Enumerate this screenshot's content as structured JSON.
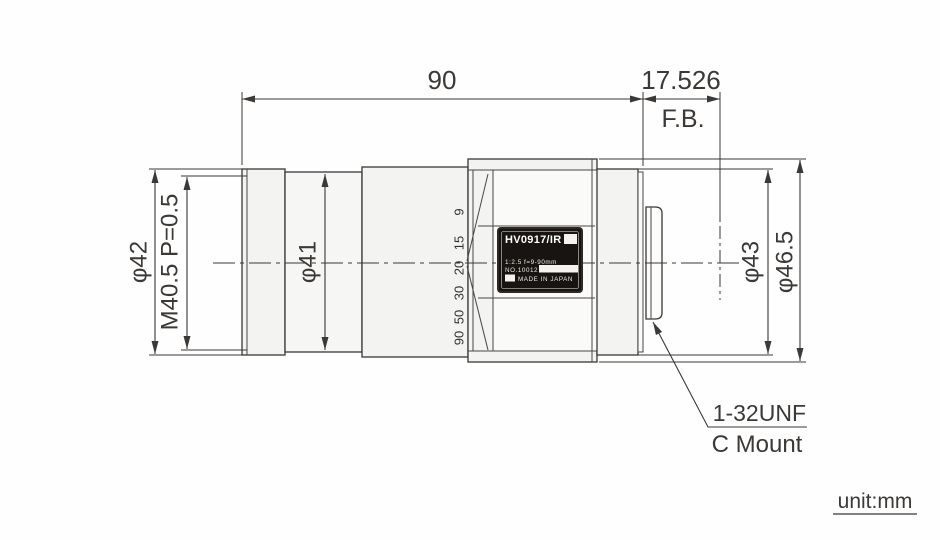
{
  "drawing": {
    "unit_note": "unit:mm",
    "dims": {
      "length": "90",
      "fb_value": "17.526",
      "fb_label": "F.B.",
      "front_dia": "φ42",
      "thread": "M40.5 P=0.5",
      "mid_dia": "φ41",
      "rear_dia": "φ43",
      "ring_dia": "φ46.5"
    },
    "mount": {
      "thread": "1-32UNF",
      "name": "C Mount"
    },
    "zoom_scale": [
      "9",
      "15",
      "20",
      "30",
      "50",
      "90"
    ],
    "nameplate": {
      "model": "HV0917/IR",
      "spec": "1:2.5 f=9-90mm",
      "serial": "NO.10012",
      "origin": "MADE IN JAPAN"
    },
    "colors": {
      "line": "#3b3835",
      "body_fill": "#f3f3f1",
      "face_fill": "#fafaf8",
      "plate_fill": "#171411",
      "background": "#fefefe"
    }
  }
}
